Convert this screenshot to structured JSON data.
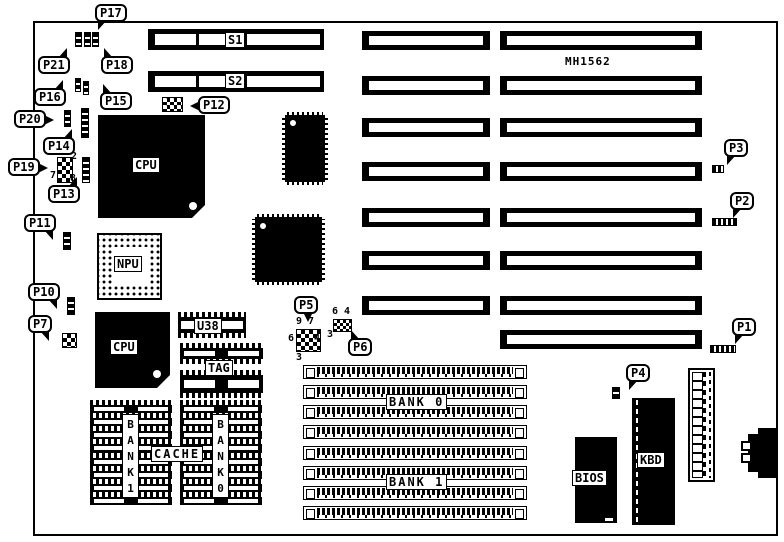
{
  "board": {
    "part_number": "MH1562"
  },
  "switches": {
    "s1": "S1",
    "s2": "S2"
  },
  "chips": {
    "cpu_main": "CPU",
    "npu": "NPU",
    "cpu_secondary": "CPU",
    "u38": "U38",
    "tag": "TAG",
    "cache": "CACHE",
    "cache_bank1": "BANK1",
    "cache_bank0": "BANK0",
    "bios": "BIOS",
    "kbd": "KBD"
  },
  "memory": {
    "bank0": "BANK 0",
    "bank1": "BANK 1"
  },
  "callouts": {
    "P1": "P1",
    "P2": "P2",
    "P3": "P3",
    "P4": "P4",
    "P5": "P5",
    "P6": "P6",
    "P7": "P7",
    "P10": "P10",
    "P11": "P11",
    "P12": "P12",
    "P13": "P13",
    "P14": "P14",
    "P15": "P15",
    "P16": "P16",
    "P17": "P17",
    "P18": "P18",
    "P19": "P19",
    "P20": "P20",
    "P21": "P21"
  },
  "pin_numbers": {
    "p19_2": "2",
    "p19_7": "7",
    "p19_8": "8",
    "p5_9": "9",
    "p5_7": "7",
    "p5_6": "6",
    "p5_4": "4",
    "p5_3": "3",
    "p6_6": "6",
    "p6_4": "4",
    "p6_3": "3"
  }
}
